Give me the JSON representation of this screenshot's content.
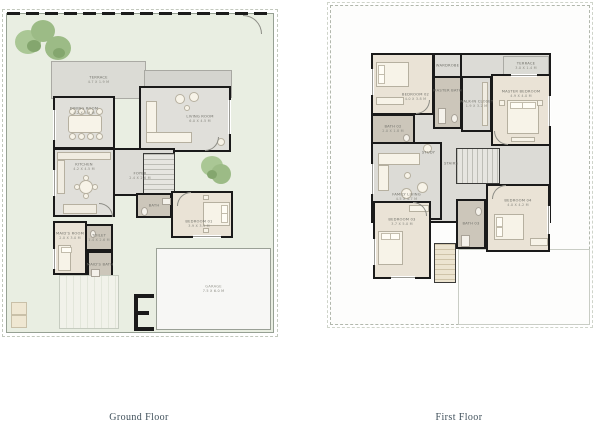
{
  "page_type": "architectural floor plan sheet",
  "colors": {
    "yard_green": "#e9eee2",
    "wall_black": "#1a1a1a",
    "room_grey": "#e0dfda",
    "bedroom_floor": "#eae3d6",
    "bath_tile": "#ccc6ba",
    "terrace_grey": "#dbdbd5",
    "garage_white": "#f7f7f5",
    "tree_green": "#9cbb86",
    "caption_text": "#40505b",
    "label_text": "#72726b"
  },
  "ground": {
    "caption": "Ground Floor",
    "rooms": {
      "terrace": {
        "name": "TERRACE",
        "dims": "4.7 X 1.9 M"
      },
      "dining": {
        "name": "DINING ROOM",
        "dims": "4.2 X 3.9 M"
      },
      "living": {
        "name": "LIVING ROOM",
        "dims": "6.0 X 4.5 M"
      },
      "kitchen": {
        "name": "KITCHEN",
        "dims": "4.2 X 4.5 M"
      },
      "foyer": {
        "name": "FOYER",
        "dims": "2.4 X 2.6 M"
      },
      "bath": {
        "name": "BATH",
        "dims": "1.5 X 2.6 M"
      },
      "bedroom01": {
        "name": "BEDROOM 01",
        "dims": "3.9 X 3.3 M"
      },
      "maids_room": {
        "name": "MAID'S ROOM",
        "dims": "2.0 X 3.0 M"
      },
      "toilet": {
        "name": "TOILET",
        "dims": "1.4 X 2.6 M"
      },
      "maids_bath": {
        "name": "MAID'S BATH",
        "dims": "1.5 X 2.0 M"
      },
      "garage": {
        "name": "GARAGE",
        "dims": "7.5 X 6.0 M"
      }
    }
  },
  "first": {
    "caption": "First Floor",
    "rooms": {
      "bedroom02": {
        "name": "BEDROOM 02",
        "dims": "4.0 X 3.8 M"
      },
      "wardrobe": {
        "name": "WARDROBE",
        "dims": "1.7 X 1.4 M"
      },
      "master_bath": {
        "name": "MASTER BATH",
        "dims": "1.7 X 3.2 M"
      },
      "wic": {
        "name": "WALK-IN CLOSET",
        "dims": "1.9 X 3.2 M"
      },
      "master": {
        "name": "MASTER BEDROOM",
        "dims": "4.9 X 4.0 M"
      },
      "terrace": {
        "name": "TERRACE",
        "dims": "3.0 X 1.4 M"
      },
      "bath02": {
        "name": "BATH 02",
        "dims": "2.0 X 1.8 M"
      },
      "study": {
        "name": "STUDY",
        "dims": ""
      },
      "family": {
        "name": "FAMILY LIVING",
        "dims": "4.5 X 4.7 M"
      },
      "stairs": {
        "name": "STAIRS",
        "dims": ""
      },
      "bedroom03": {
        "name": "BEDROOM 03",
        "dims": "3.7 X 5.0 M"
      },
      "bath03": {
        "name": "BATH 03",
        "dims": "2.0 X 2.9 M"
      },
      "bedroom04": {
        "name": "BEDROOM 04",
        "dims": "4.0 X 4.2 M"
      }
    }
  }
}
